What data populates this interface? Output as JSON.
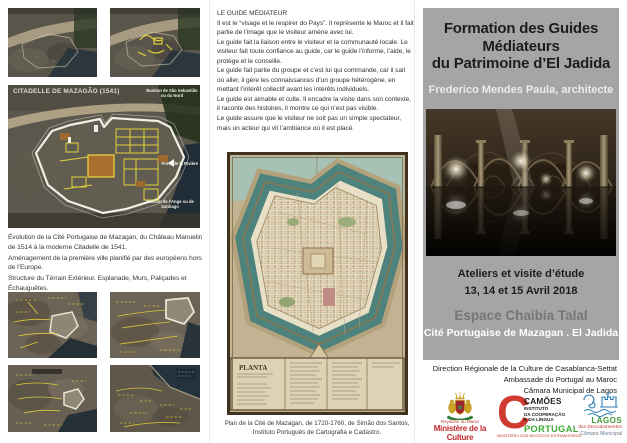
{
  "left_panel": {
    "citadel": {
      "title": "CITADELLE DE MAZAGÃO (1541)",
      "label_bastion_nord": "Bastion de São Sebastião ou du Nord",
      "label_porte_riviere": "Porte de la Rivière",
      "label_bastion_ange": "Bastion de l’Ange ou de Santiago"
    },
    "captions": [
      "Évolution de la Cité Portugaise de Mazagan, du Château Manuelin de 1514 à la moderne Citadelle de 1541.",
      "Aménagement de la première ville planifié par des européens hors de l’Europe.",
      "Structure du Térrain Extérieur. Esplanade, Murs, Paliçades et Échauguêtes."
    ]
  },
  "middle_panel": {
    "heading": "LE GUIDE MÉDIATEUR",
    "paragraphs": [
      "Il est le “visage et le respirer do Pays”. Il représente le Maroc et il fait partie de l’image que le visiteur amène avec lui.",
      "Le guide fait la liaison entre le visiteur et la communauté locale. Le visiteur fait toute confiance au guide, car le guide l’informe, l’aide, le protège et le conseille.",
      "Le guide fait partie du groupe et c’est lui qui commande, car il sait où aller, il gère les connaissances d’un groupe hétérogène, en mettant l’intérêt collectif avant les intérêts individuels.",
      "Le guide est aimable et culte. Il encadre la visite dans son contexte, il raconte des histoires, il montre ce qui n’est pas visible.",
      "Le guide assure que le visiteur ne soit pas un simple spectateur, mais un acteur qui vit l’ambiance où il est placé."
    ],
    "map": {
      "legend_title": "PLANTA",
      "caption_line1": "Plan de la Cité de Mazagan, de 1720-1760, de Simão dos Santos,",
      "caption_line2": "Instituto Português de Cartografia e Cadastro."
    }
  },
  "right_panel": {
    "title_lines": [
      "Formation des Guides",
      "Médiateurs",
      "du Patrimoine d’El Jadida"
    ],
    "author": "Frederico Mendes Paula, architecte",
    "event_lines": [
      "Ateliers et visite d’étude",
      "13, 14 et 15 Avril 2018"
    ],
    "venue_line1": "Espace Chaibia Talal",
    "venue_line2": "Cité Portugaise de Mazagan . El Jadida",
    "credits": [
      "Direction Régionale de la Culture de Casablanca-Settat",
      "Ambassade du Portugal au Maroc",
      "Câmara Municipal de Lagos"
    ],
    "logos": {
      "ministere": {
        "kingdom": "Royaume du Maroc",
        "name": "Ministère de la Culture"
      },
      "camoes": {
        "initial": "C",
        "name": "CAMÕES",
        "line1": "INSTITUTO",
        "line2": "DA COOPERAÇÃO",
        "line3": "E DA LÍNGUA",
        "country": "PORTUGAL",
        "ministry": "MINISTÉRIO DOS NEGÓCIOS ESTRANGEIROS"
      },
      "lagos": {
        "name": "LAGOS",
        "tagline": "dos Descobrimentos",
        "municipal": "Câmara Municipal"
      }
    }
  },
  "colors": {
    "panel_gray": "#a5a5a5",
    "title_dark": "#1d1d1d",
    "author_light": "#ececec",
    "venue_gray": "#767676",
    "annotation_yellow": "#ecd83c",
    "camoes_red": "#d13a2e",
    "portugal_green": "#3aaa35",
    "lagos_blue": "#2e7fb8",
    "ministry_red": "#c0272d",
    "map_moat_teal": "#4d827d",
    "map_parchment": "#c6b897"
  }
}
